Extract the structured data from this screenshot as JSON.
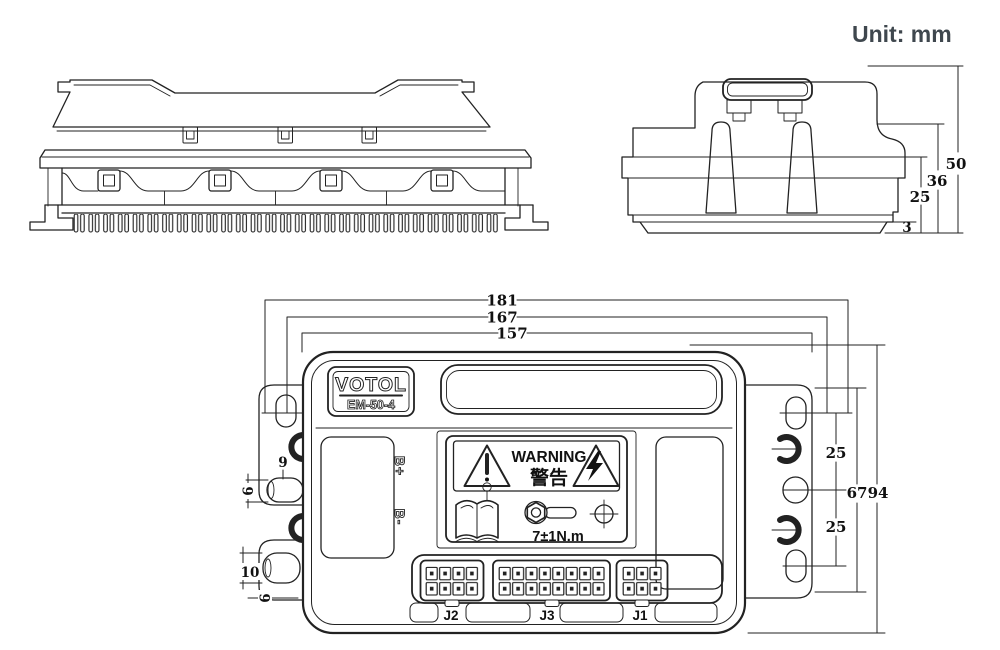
{
  "unit_label": "Unit: mm",
  "device": {
    "brand": "VOTOL",
    "model": "EM-50-4"
  },
  "labels": {
    "warning_en": "WARNING",
    "warning_zh": "警告",
    "torque": "7±1N.m",
    "b_plus": "B+",
    "b_minus": "B-",
    "j1": "J1",
    "j2": "J2",
    "j3": "J3"
  },
  "dimensions": {
    "top_width": [
      "181",
      "167",
      "157"
    ],
    "end_view": {
      "total_height": "50",
      "mid_height": "36",
      "lower_height": "25",
      "base_plate": "3"
    },
    "right_side": {
      "top_slot_spacing": "25",
      "flange_length": "67",
      "overall_height": "94",
      "bottom_slot_spacing": "25"
    },
    "left_side": {
      "upper_stud_offset": "9",
      "upper_stud_dia": "6",
      "lower_stud_length": "10",
      "lower_stud_dia": "6"
    }
  }
}
